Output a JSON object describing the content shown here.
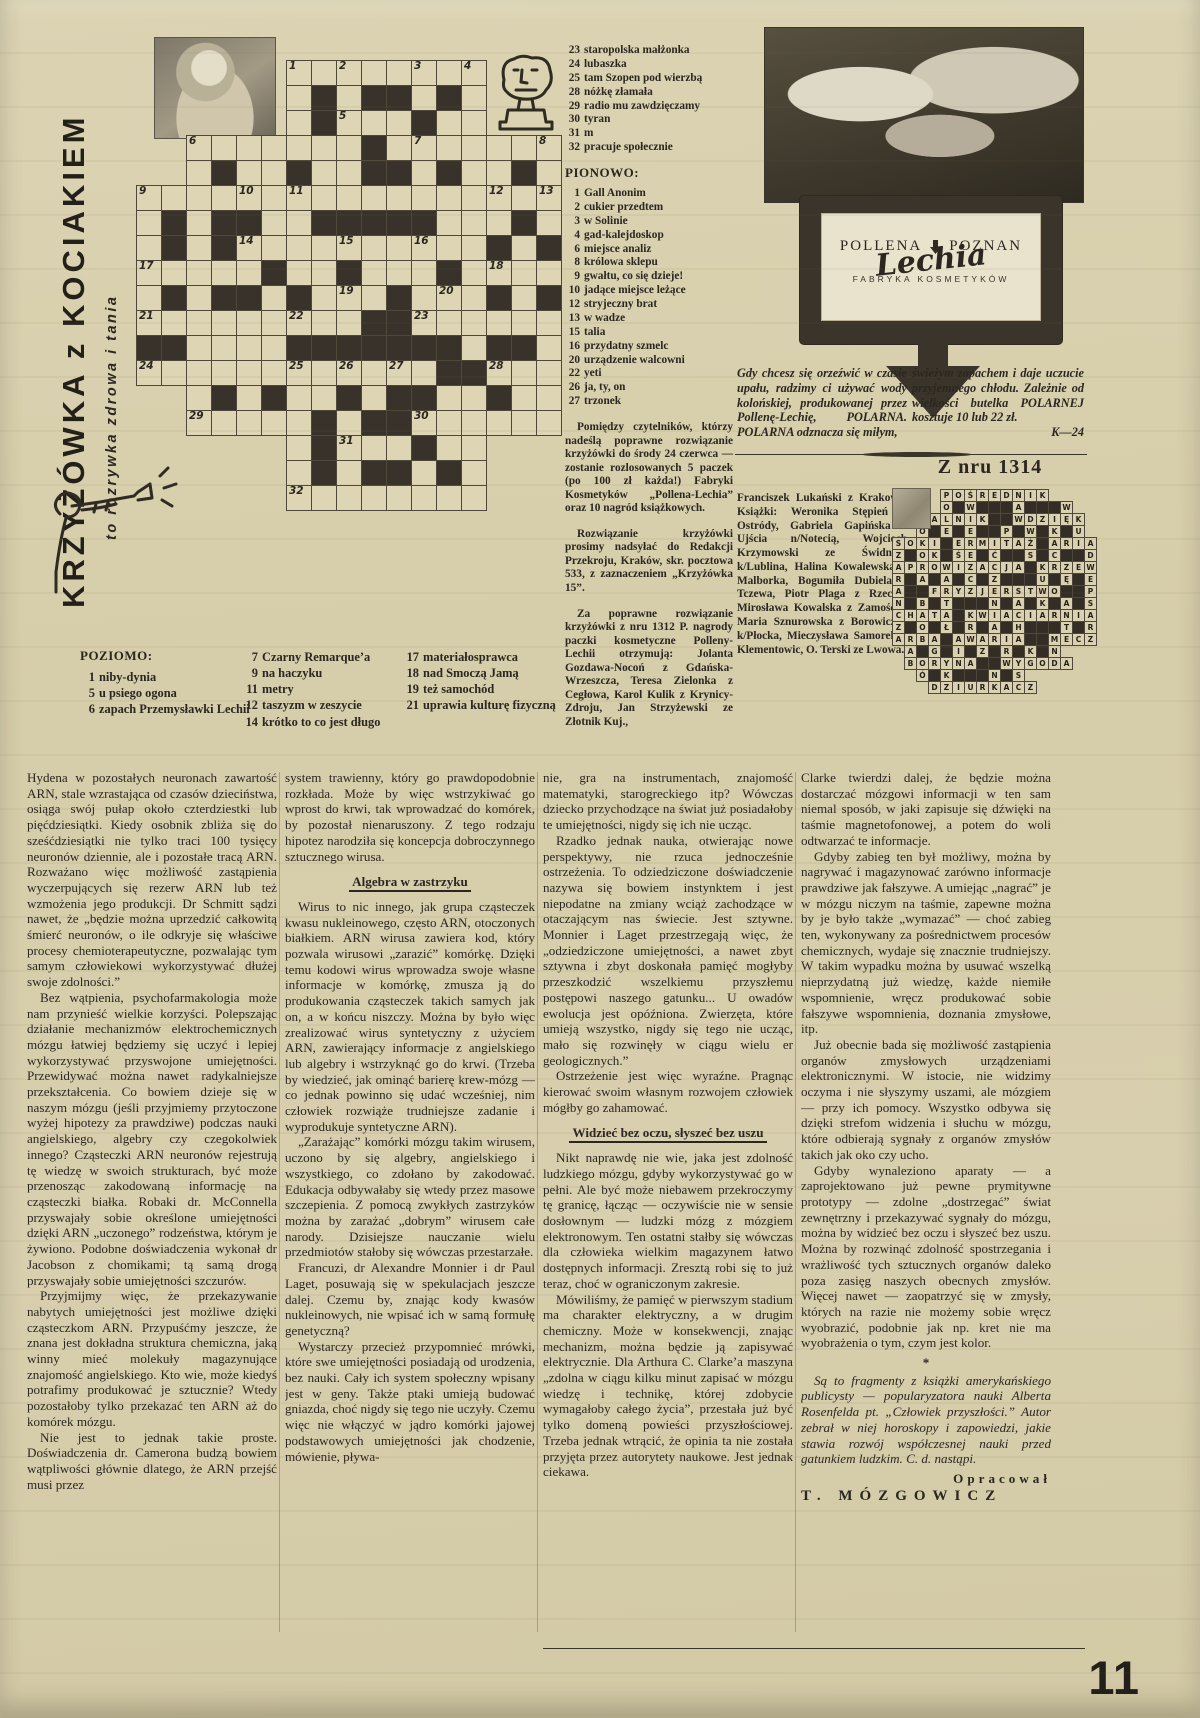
{
  "page": {
    "number": "11"
  },
  "masthead": {
    "title": "KRZYŻÓWKA z KOCIAKIEM",
    "subtitle": "to rozrywka zdrowa i tania"
  },
  "puzzle": {
    "across_label": "POZIOMO:",
    "down_label": "PIONOWO:",
    "grid": {
      "rows": [
        "......wwwwwwww...",
        "......wbwbbwbw...",
        "......wbwwwbww...",
        "..wwwwwwwbwwwwwww",
        "..wbwwbwwbbwbwwbw",
        "wwwwwwwwwwwwwwwww",
        "wbwbbwwbbbbbwwwbw",
        "wbwbwwwwwwwwwwbwb",
        "wwwwwbwwbwwwbwwww",
        "wbwbbwbwwwbwwwbwb",
        "wwwwwwwwwbbwwwwww",
        "bbwwwwbbbbbbbwbbw",
        "wwwwwwwwwwwwbbwww",
        "..wbwbwwbwbbwwbww",
        "..wwwwwbwbbwwwwww",
        "......wbwwwbww...",
        "......wbwbbwbw...",
        "......wwwwwwww..."
      ],
      "numbers": {
        "0,6": "1",
        "0,8": "2",
        "0,11": "3",
        "0,13": "4",
        "2,8": "5",
        "3,2": "6",
        "3,11": "7",
        "3,16": "8",
        "5,0": "9",
        "5,4": "10",
        "5,6": "11",
        "5,14": "12",
        "5,16": "13",
        "7,4": "14",
        "7,8": "15",
        "7,11": "16",
        "8,0": "17",
        "8,14": "18",
        "9,8": "19",
        "9,12": "20",
        "10,0": "21",
        "10,6": "22",
        "10,11": "23",
        "12,0": "24",
        "12,6": "25",
        "12,8": "26",
        "12,10": "27",
        "12,14": "28",
        "14,2": "29",
        "14,11": "30",
        "15,8": "31",
        "17,6": "32"
      }
    },
    "across_a": [
      {
        "n": "1",
        "t": "niby-dynia"
      },
      {
        "n": "5",
        "t": "u psiego ogona"
      },
      {
        "n": "6",
        "t": "zapach Przemysławki Lechii"
      }
    ],
    "across_b": [
      {
        "n": "7",
        "t": "Czarny Remarque’a"
      },
      {
        "n": "9",
        "t": "na haczyku"
      },
      {
        "n": "11",
        "t": "metry"
      },
      {
        "n": "12",
        "t": "taszyzm w zeszycie"
      },
      {
        "n": "14",
        "t": "krótko to co jest długo"
      }
    ],
    "across_c": [
      {
        "n": "17",
        "t": "materiałosprawca"
      },
      {
        "n": "18",
        "t": "nad Smoczą Jamą"
      },
      {
        "n": "19",
        "t": "też samochód"
      },
      {
        "n": "21",
        "t": "uprawia kulturę fizyczną"
      }
    ],
    "across_d": [
      {
        "n": "23",
        "t": "staropolska małżonka"
      },
      {
        "n": "24",
        "t": "lubaszka"
      },
      {
        "n": "25",
        "t": "tam Szopen pod wierzbą"
      },
      {
        "n": "28",
        "t": "nóżkę złamała"
      },
      {
        "n": "29",
        "t": "radio mu zawdzięczamy"
      },
      {
        "n": "30",
        "t": "tyran"
      },
      {
        "n": "31",
        "t": "m"
      },
      {
        "n": "32",
        "t": "pracuje społecznie"
      }
    ],
    "down": [
      {
        "n": "1",
        "t": "Gall Anonim"
      },
      {
        "n": "2",
        "t": "cukier przedtem"
      },
      {
        "n": "3",
        "t": "w Solinie"
      },
      {
        "n": "4",
        "t": "gad-kalejdoskop"
      },
      {
        "n": "6",
        "t": "miejsce analiz"
      },
      {
        "n": "8",
        "t": "królowa sklepu"
      },
      {
        "n": "9",
        "t": "gwałtu, co się dzieje!"
      },
      {
        "n": "10",
        "t": "jadące miejsce leżące"
      },
      {
        "n": "12",
        "t": "stryjeczny brat"
      },
      {
        "n": "13",
        "t": "w wadze"
      },
      {
        "n": "15",
        "t": "talia"
      },
      {
        "n": "16",
        "t": "przydatny szmelc"
      },
      {
        "n": "20",
        "t": "urządzenie walcowni"
      },
      {
        "n": "22",
        "t": "yeti"
      },
      {
        "n": "26",
        "t": "ja, ty, on"
      },
      {
        "n": "27",
        "t": "trzonek"
      }
    ]
  },
  "contest": {
    "p1": "Pomiędzy czytelników, którzy nadeślą poprawne rozwiązanie krzyżówki do środy 24 czerwca — zostanie rozlosowanych 5 paczek (po 100 zł każda!) Fabryki Kosmetyków „Pollena-Lechia” oraz 10 nagród książkowych.",
    "p2": "Rozwiązanie krzyżówki prosimy nadsyłać do Redakcji Przekroju, Kraków, skr. pocztowa 533, z zaznaczeniem „Krzyżówka 15”.",
    "p3": "Za poprawne rozwiązanie krzyżówki z nru 1312 P. nagrody paczki kosmetyczne Polleny-Lechii otrzymują: Jolanta Gozdawa-Nocoń z Gdańska-Wrzeszcza, Teresa Zielonka z Cegłowa, Karol Kulik z Krynicy-Zdroju, Jan Strzyżewski ze Złotnik Kuj.,",
    "winners": "Franciszek Lukański z Krakowa. Książki: Weronika Stępień z Ostródy, Gabriela Gapińska z Ujścia n/Notecią, Wojciech Krzymowski ze Świdnika k/Lublina, Halina Kowalewska z Malborka, Bogumiła Dubiela z Tczewa, Piotr Plaga z Rzecka, Mirosława Kowalska z Zamościa, Maria Sznurowska z Borowiczek k/Płocka, Mieczysława Samorek z Klementowic, O. Terski ze Lwowa."
  },
  "ad": {
    "brand_left": "POLLENA",
    "brand_right": "POZNAN",
    "brand_script": "Lechia",
    "brand_sub": "FABRYKA KOSMETYKÓW",
    "copy_left": "Gdy chcesz się orzeźwić w czasie upału, radzimy ci używać wody kolońskiej, produkowanej przez Pollenę-Lechię, POLARNA. POLARNA odznacza się miłym,",
    "copy_right": "świeżym zapachem i daje uczucie przyjemnego chłodu. Zależnie od wielkości butelka POLARNEJ kosztuje 10 lub 22 zł.",
    "code": "K—24"
  },
  "solution": {
    "heading": "Z nru 1314",
    "rows": [
      "....POŚREDNIK....",
      "....O#W###A###W..",
      "..PALNIK##WDZIĘK.",
      "..O#E#E##P#W#K#U.",
      "SOKI#ERMITAŻ#ARIA",
      "Z#OK#ŚE#Ć##S#C##D",
      "APROWIZACJA#KRZEW",
      "R#A#A#C#Z###U#Ę#E",
      "A##FRYZJERSTWO##P",
      "N#B#T###N#A#K#A#S",
      "CHATA#KWIACIARNIA",
      "Z#O#Ł#R#A#H###T#R",
      "ARBA#AWARIA##MECZ",
      ".A#G#I#Z#R#K#N...",
      ".BORYNA##WYGODA..",
      "..Ó#K###N#S......",
      "...DZIURKACZ....."
    ]
  },
  "article": {
    "columns": [
      [
        {
          "s": "p0",
          "t": "Hydena w pozostałych neuronach zawartość ARN, stale wzrastająca od czasów dzieciństwa, osiąga swój pułap około czterdziestki lub pięćdziesiątki. Kiedy osobnik zbliża się do sześćdziesiątki nie tylko traci 100 tysięcy neuronów dziennie, ale i pozostałe tracą ARN. Rozważano więc możliwość zastąpienia wyczerpujących się rezerw ARN lub też wzmożenia jego produkcji. Dr Schmitt sądzi nawet, że „będzie można uprzedzić całkowitą śmierć neuronów, o ile odkryje się właściwe procesy chemioterapeutyczne, pozwalając tym samym człowiekowi wykorzystywać dłużej swoje zdolności.”"
        },
        {
          "s": "p",
          "t": "Bez wątpienia, psychofarmakologia może nam przynieść wielkie korzyści. Polepszając działanie mechanizmów elektrochemicznych mózgu łatwiej będziemy się uczyć i lepiej wykorzystywać przyswojone umiejętności. Przewidywać można nawet radykalniejsze przekształcenia. Co bowiem dzieje się w naszym mózgu (jeśli przyjmiemy przytoczone wyżej hipotezy za prawdziwe) podczas nauki angielskiego, algebry czy czegokolwiek innego? Cząsteczki ARN neuronów rejestrują tę wiedzę w swoich strukturach, być może przenosząc zakodowaną informację na cząsteczki białka. Robaki dr. McConnella przyswajały sobie określone umiejętności dzięki ARN „uczonego” rodzeństwa, którym je żywiono. Podobne doświadczenia wykonał dr Jacobson z chomikami; tą samą drogą przyswajały sobie umiejętności szczurów."
        },
        {
          "s": "p",
          "t": "Przyjmijmy więc, że przekazywanie nabytych umiejętności jest możliwe dzięki cząsteczkom ARN. Przypuśćmy jeszcze, że znana jest dokładna struktura chemiczna, jaką winny mieć molekuły magazynujące znajomość angielskiego. Kto wie, może kiedyś potrafimy produkować je sztucznie? Wtedy pozostałoby tylko przekazać ten ARN aż do komórek mózgu."
        },
        {
          "s": "p",
          "t": "Nie jest to jednak takie proste. Doświadczenia dr. Camerona budzą bowiem wątpliwości głównie dlatego, że ARN przejść musi przez"
        }
      ],
      [
        {
          "s": "p0",
          "t": "system trawienny, który go prawdopodobnie rozkłada. Może by więc wstrzykiwać go wprost do krwi, tak wprowadzać do komórek, by pozostał nienaruszony. Z tego rodzaju hipotez narodziła się koncepcja dobroczynnego sztucznego wirusa."
        },
        {
          "s": "h",
          "t": "Algebra w zastrzyku"
        },
        {
          "s": "p",
          "t": "Wirus to nic innego, jak grupa cząsteczek kwasu nukleinowego, często ARN, otoczonych białkiem. ARN wirusa zawiera kod, który pozwala wirusowi „zarazić” komórkę. Dzięki temu kodowi wirus wprowadza swoje własne informacje w komórkę, zmusza ją do produkowania cząsteczek takich samych jak on, a w końcu niszczy. Można by było więc zrealizować wirus syntetyczny z użyciem ARN, zawierający informacje z angielskiego lub algebry i wstrzyknąć go do krwi. (Trzeba by wiedzieć, jak ominąć barierę krew-mózg — co jednak powinno się udać wcześniej, nim człowiek rozwiąże trudniejsze zadanie i wyprodukuje syntetyczne ARN)."
        },
        {
          "s": "p",
          "t": "„Zarażając” komórki mózgu takim wirusem, uczono by się algebry, angielskiego i wszystkiego, co zdołano by zakodować. Edukacja odbywałaby się wtedy przez masowe szczepienia. Z pomocą zwykłych zastrzyków można by zarażać „dobrym” wirusem całe narody. Dzisiejsze nauczanie wielu przedmiotów stałoby się wówczas przestarzałe."
        },
        {
          "s": "p",
          "t": "Francuzi, dr Alexandre Monnier i dr Paul Laget, posuwają się w spekulacjach jeszcze dalej. Czemu by, znając kody kwasów nukleinowych, nie wpisać ich w samą formułę genetyczną?"
        },
        {
          "s": "p",
          "t": "Wystarczy przecież przypomnieć mrówki, które swe umiejętności posiadają od urodzenia, bez nauki. Cały ich system społeczny wpisany jest w geny. Także ptaki umieją budować gniazda, choć nigdy się tego nie uczyły. Czemu więc nie włączyć w jądro komórki jajowej podstawowych umiejętności jak chodzenie, mówienie, pływa-"
        }
      ],
      [
        {
          "s": "p0",
          "t": "nie, gra na instrumentach, znajomość matematyki, starogreckiego itp? Wówczas dziecko przychodzące na świat już posiadałoby te umiejętności, nigdy się ich nie ucząc."
        },
        {
          "s": "p",
          "t": "Rzadko jednak nauka, otwierając nowe perspektywy, nie rzuca jednocześnie ostrzeżenia. To odziedziczone doświadczenie nazywa się bowiem instynktem i jest niepodatne na zmiany wciąż zachodzące w otaczającym nas świecie. Jest sztywne. Monnier i Laget przestrzegają więc, że „odziedziczone umiejętności, a nawet zbyt sztywna i zbyt doskonała pamięć mogłyby przeszkodzić wszelkiemu przyszłemu postępowi naszego gatunku... U owadów ewolucja jest opóźniona. Zwierzęta, które umieją wszystko, nigdy się tego nie ucząc, mało się rozwinęły w ciągu wielu er geologicznych.”"
        },
        {
          "s": "p",
          "t": "Ostrzeżenie jest więc wyraźne. Pragnąc kierować swoim własnym rozwojem człowiek mógłby go zahamować."
        },
        {
          "s": "h",
          "t": "Widzieć bez oczu, słyszeć bez uszu"
        },
        {
          "s": "p",
          "t": "Nikt naprawdę nie wie, jaka jest zdolność ludzkiego mózgu, gdyby wykorzystywać go w pełni. Ale być może niebawem przekroczymy tę granicę, łącząc — oczywiście nie w sensie dosłownym — ludzki mózg z mózgiem elektronowym. Ten ostatni stałby się wówczas dla człowieka wielkim magazynem łatwo dostępnych informacji. Zresztą robi się to już teraz, choć w ograniczonym zakresie."
        },
        {
          "s": "p",
          "t": "Mówiliśmy, że pamięć w pierwszym stadium ma charakter elektryczny, a w drugim chemiczny. Może w konsekwencji, znając mechanizm, można będzie ją zapisywać elektrycznie. Dla Arthura C. Clarke’a maszyna „zdolna w ciągu kilku minut zapisać w mózgu wiedzę i technikę, której zdobycie wymagałoby całego życia”, przestała już być tylko domeną powieści przyszłościowej. Trzeba jednak wtrącić, że opinia ta nie została przyjęta przez autorytety naukowe. Jest jednak ciekawa."
        }
      ],
      [
        {
          "s": "p0",
          "t": "Clarke twierdzi dalej, że będzie można dostarczać mózgowi informacji w ten sam niemal sposób, w jaki zapisuje się dźwięki na taśmie magnetofonowej, a potem do woli odtwarzać te informacje."
        },
        {
          "s": "p",
          "t": "Gdyby zabieg ten był możliwy, można by nagrywać i magazynować zarówno informacje prawdziwe jak fałszywe. A umiejąc „nagrać” je w mózgu niczym na taśmie, zapewne można by je było także „wymazać” — choć zabieg ten, wykonywany za pośrednictwem procesów chemicznych, wydaje się znacznie trudniejszy. W takim wypadku można by usuwać wszelką nieprzydatną już wiedzę, każde niemiłe wspomnienie, wręcz produkować sobie fałszywe wspomnienia, doznania zmysłowe, itp."
        },
        {
          "s": "p",
          "t": "Już obecnie bada się możliwość zastąpienia organów zmysłowych urządzeniami elektronicznymi. W istocie, nie widzimy oczyma i nie słyszymy uszami, ale mózgiem — przy ich pomocy. Wszystko odbywa się dzięki strefom widzenia i słuchu w mózgu, które odbierają sygnały z organów zmysłów takich jak oko czy ucho."
        },
        {
          "s": "p",
          "t": "Gdyby wynaleziono aparaty — a zaprojektowano już pewne prymitywne prototypy — zdolne „dostrzegać” świat zewnętrzny i przekazywać sygnały do mózgu, można by widzieć bez oczu i słyszeć bez uszu. Można by rozwinąć zdolność spostrzegania i wrażliwość tych sztucznych organów daleko poza zasięg naszych obecnych zmysłów. Więcej nawet — zaopatrzyć się w zmysły, których na razie nie możemy sobie wręcz wyobrazić, podobnie jak np. kret nie ma wyobrażenia o tym, czym jest kolor."
        },
        {
          "s": "star",
          "t": "*"
        },
        {
          "s": "i",
          "t": "Są to fragmenty z książki amerykańskiego publicysty — popularyzatora nauki Alberta Rosenfelda pt. „Człowiek przyszłości.” Autor zebrał w niej horoskopy i zapowiedzi, jakie stawia rozwój współczesnej nauki przed gatunkiem ludzkim. C. d. nastąpi."
        },
        {
          "s": "credit",
          "t": "Opracował"
        },
        {
          "s": "author",
          "t": "T. MÓZGOWICZ"
        }
      ]
    ]
  }
}
